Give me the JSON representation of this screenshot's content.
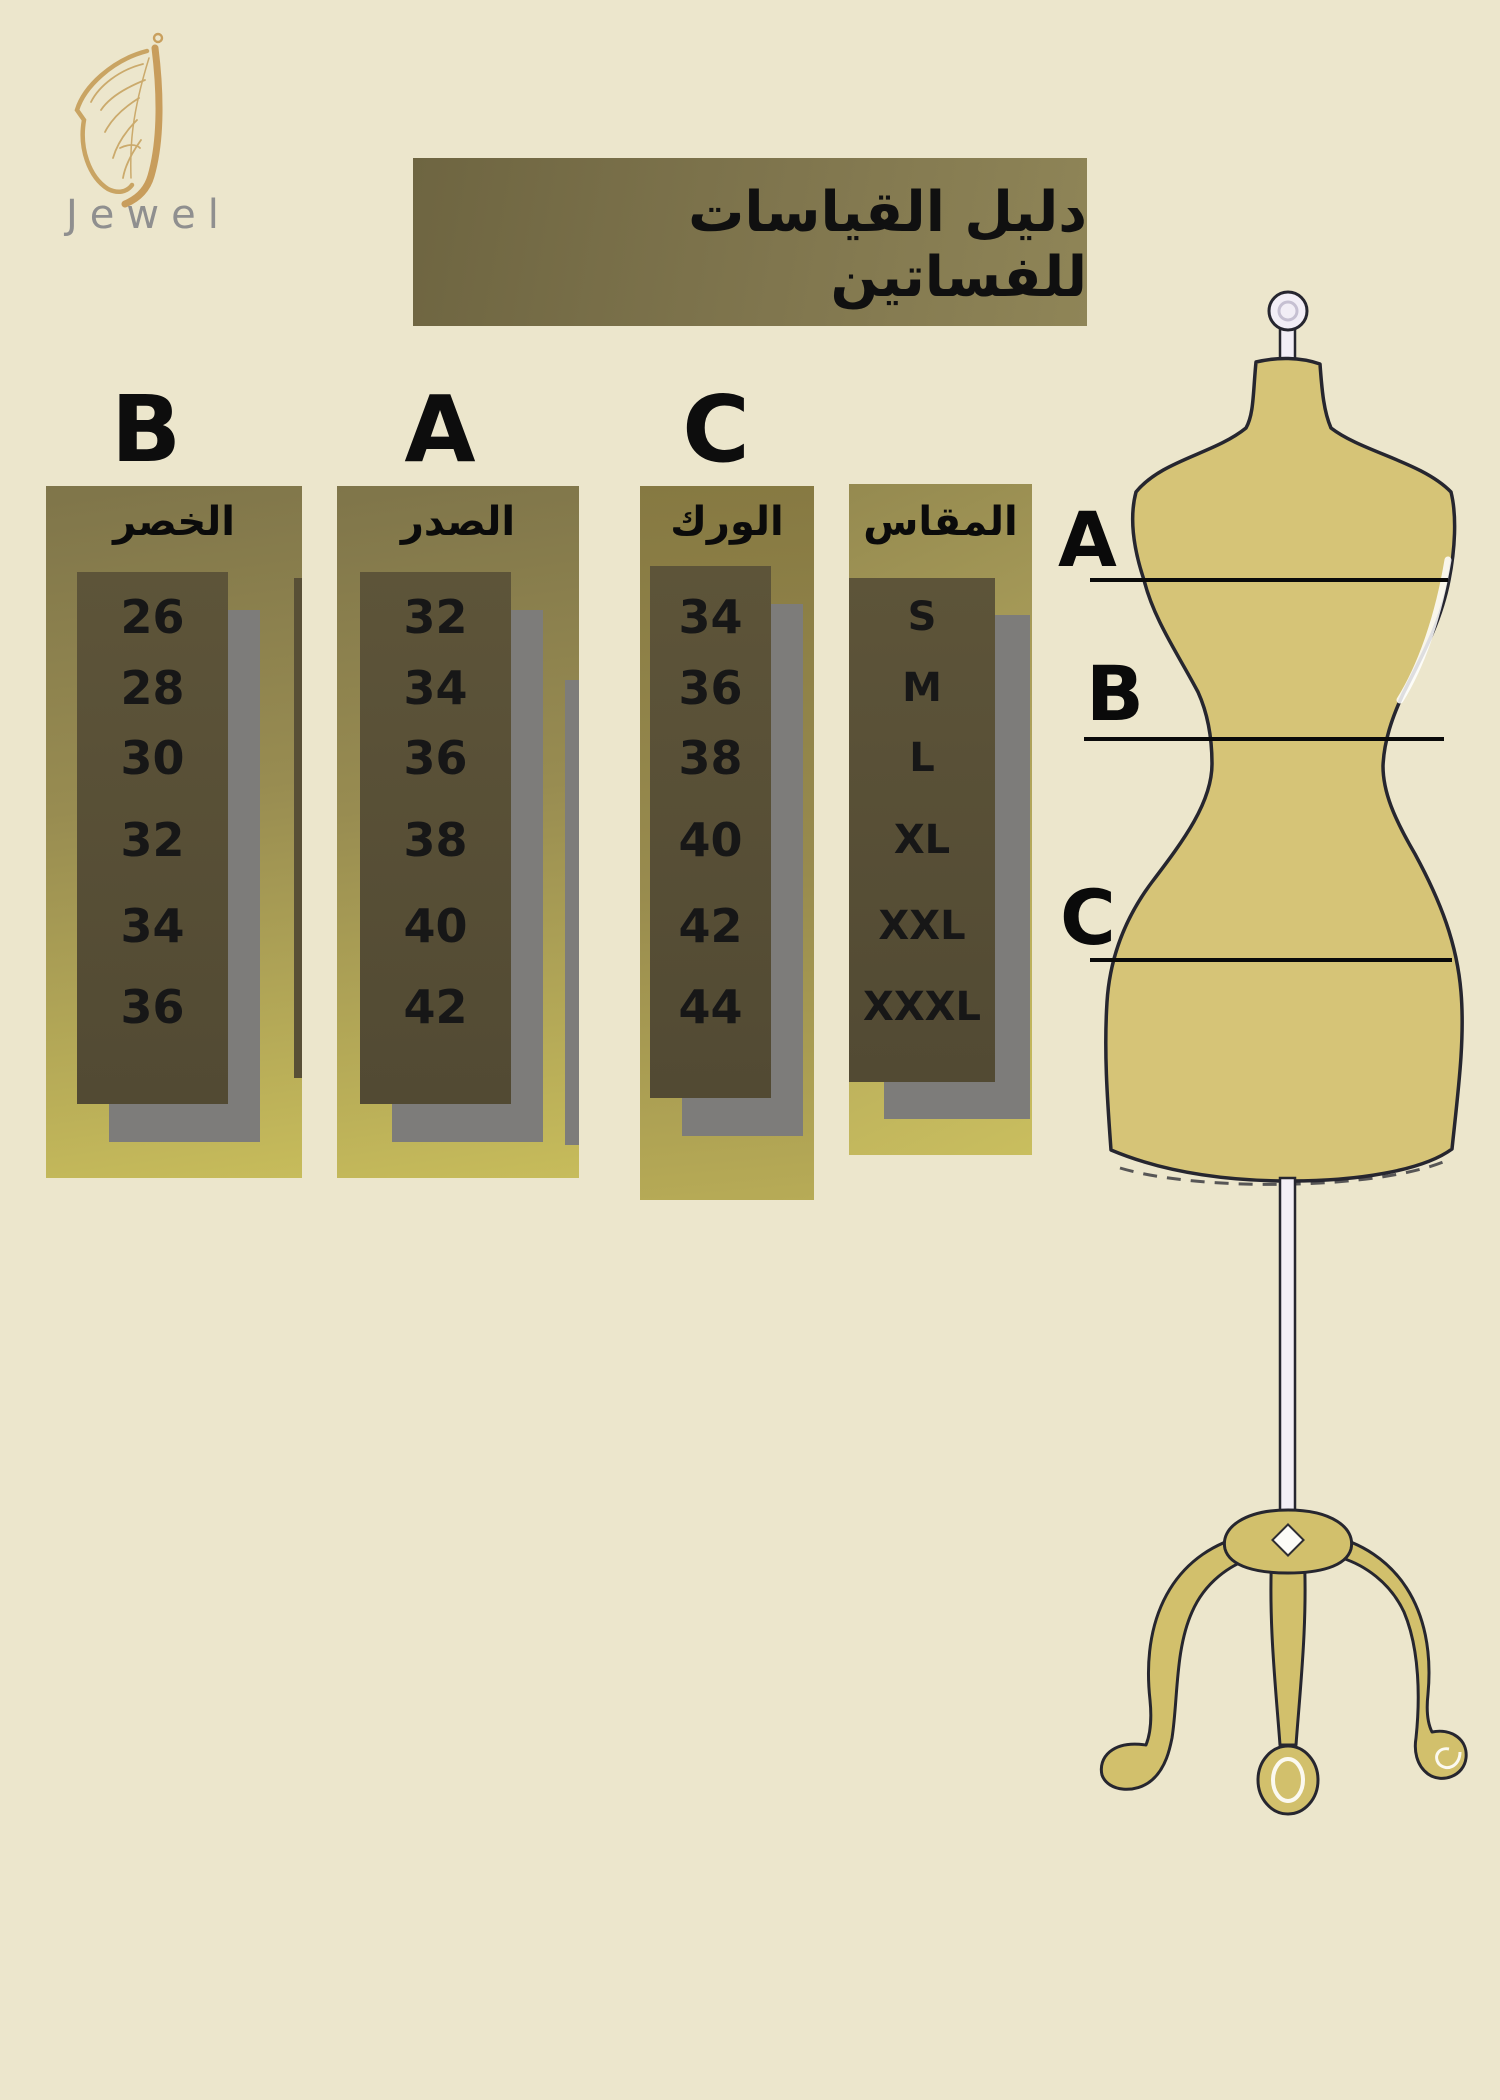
{
  "brand": {
    "logo_text": "Jewel",
    "logo_icon": "butterfly-wing-icon"
  },
  "title": "دليل القياسات للفساتين",
  "size_chart": {
    "columns": [
      {
        "letter": "B",
        "header": "الخصر",
        "values": [
          "26",
          "28",
          "30",
          "32",
          "34",
          "36"
        ]
      },
      {
        "letter": "A",
        "header": "الصدر",
        "values": [
          "32",
          "34",
          "36",
          "38",
          "40",
          "42"
        ]
      },
      {
        "letter": "C",
        "header": "الورك",
        "values": [
          "34",
          "36",
          "38",
          "40",
          "42",
          "44"
        ]
      },
      {
        "letter": "",
        "header": "المقاس",
        "values": [
          "S",
          "M",
          "L",
          "XL",
          "XXL",
          "XXXL"
        ]
      }
    ]
  },
  "mannequin": {
    "labels": [
      "A",
      "B",
      "C"
    ]
  },
  "colors": {
    "background": "#ece6cc",
    "banner_olive": "#7d7349",
    "column_gold_dark": "#7f754a",
    "column_gold_light": "#c7bc5b",
    "inner_panel": "#584f36",
    "shadow_gray": "#7d7c7a",
    "mannequin_gold": "#d6c477",
    "outline_dark": "#26262f",
    "logo_gold": "#c9a05e",
    "jewel_text_gray": "#8f8f8f",
    "text_dark": "#141414"
  }
}
